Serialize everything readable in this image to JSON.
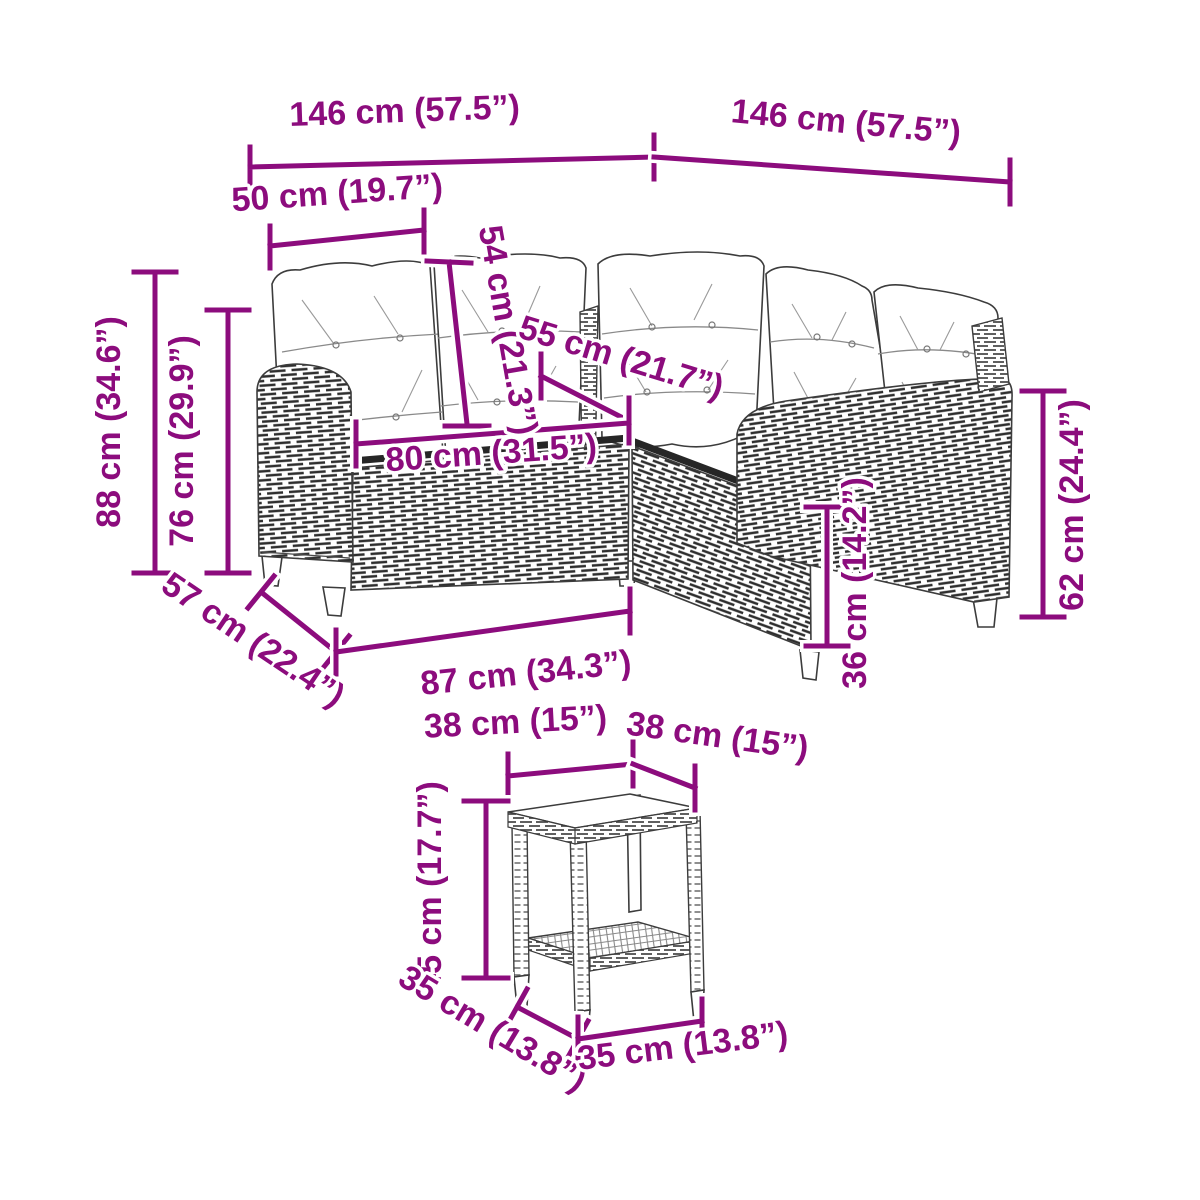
{
  "figure": {
    "kind": "product dimension diagram",
    "subject": "L-shaped poly rattan garden sofa with cushions and square side table"
  },
  "colors": {
    "annotation": "#8c0c7d",
    "line_art": "#3c3c3c",
    "background": "#ffffff"
  },
  "dims": {
    "sofa_width_left": {
      "label": "146 cm (57.5”)"
    },
    "sofa_width_right": {
      "label": "146 cm (57.5”)"
    },
    "armrest_section": {
      "label": "50 cm (19.7”)"
    },
    "backrest_height": {
      "label": "54 cm (21.3”)"
    },
    "seat_depth": {
      "label": "55 cm (21.7”)"
    },
    "seat_width": {
      "label": "80 cm (31.5”)"
    },
    "total_height": {
      "label": "88 cm (34.6”)"
    },
    "back_height": {
      "label": "76 cm (29.9”)"
    },
    "base_depth": {
      "label": "57 cm (22.4”)"
    },
    "base_width": {
      "label": "87 cm (34.3”)"
    },
    "seat_height": {
      "label": "36 cm (14.2”)"
    },
    "armrest_height": {
      "label": "62 cm (24.4”)"
    },
    "table_top_left": {
      "label": "38 cm (15”)"
    },
    "table_top_right": {
      "label": "38 cm (15”)"
    },
    "table_height": {
      "label": "45 cm (17.7”)"
    },
    "table_base_left": {
      "label": "35 cm (13.8”)"
    },
    "table_base_right": {
      "label": "35 cm (13.8”)"
    }
  }
}
